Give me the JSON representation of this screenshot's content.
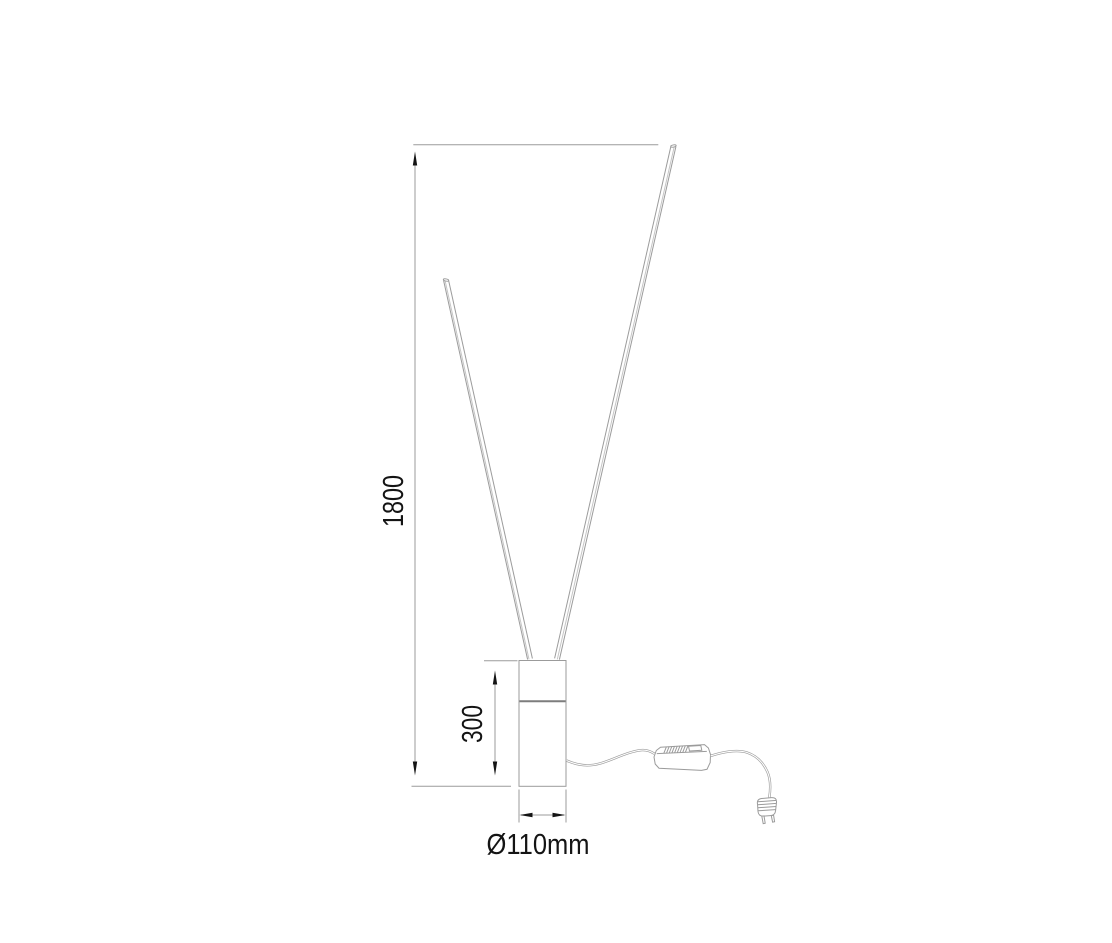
{
  "diagram": {
    "type": "technical-dimension-drawing",
    "subject": "floor lamp with two slanted LED light rods, cylindrical base, cord with LED driver box and power plug",
    "labels": {
      "total_height": "1800",
      "base_height": "300",
      "base_diameter": "Ø110mm"
    },
    "parts": [
      "left-light-rod",
      "right-light-rod",
      "cylindrical-base",
      "power-cord",
      "led-driver-box",
      "power-plug"
    ],
    "colors": {
      "background": "#ffffff",
      "drawing_line": "#9b9b9b",
      "highlight_line": "#c6c6c6",
      "seam_line": "#7d7d7d",
      "dimension_text": "#141414",
      "arrowhead": "#141414"
    }
  }
}
